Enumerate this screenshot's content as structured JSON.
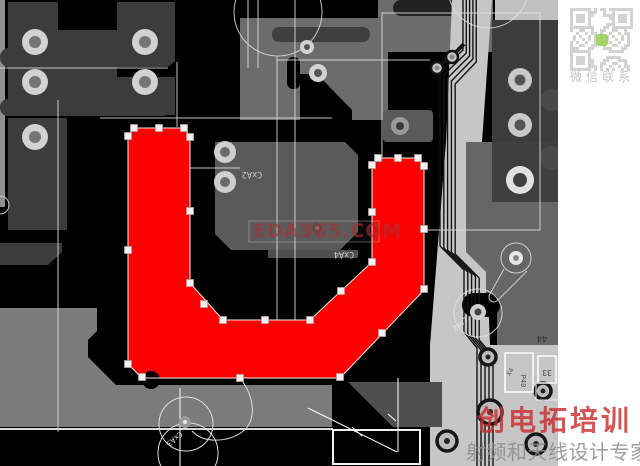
{
  "watermarks": {
    "center": "EDA365.COM",
    "brand_line1": "创电拓培训",
    "brand_line2": "射频和天线设计专家"
  },
  "qr": {
    "caption": "微信联系"
  },
  "silkscreen_labels": {
    "cxa2": "CxA2",
    "cxa4": "CxA4",
    "cxa3": "CxA3",
    "v26": "26v7",
    "n44": "44",
    "n33": "33",
    "p40": "P40",
    "x4": "X4"
  },
  "colors": {
    "background": "#000000",
    "plane_dark": "#3c3c3c",
    "plane_mid": "#666666",
    "plane_center": "#5a5a5a",
    "plane_bottom": "#7b7b7b",
    "plane_light": "#c6c6c6",
    "copper_selected": "#fb0100",
    "handle_fill": "#f6f1f0",
    "outline_white": "#e2e2e2",
    "watermark_red": "rgba(205,45,45,0.82)",
    "watermark_gray": "rgba(140,140,140,0.85)"
  }
}
